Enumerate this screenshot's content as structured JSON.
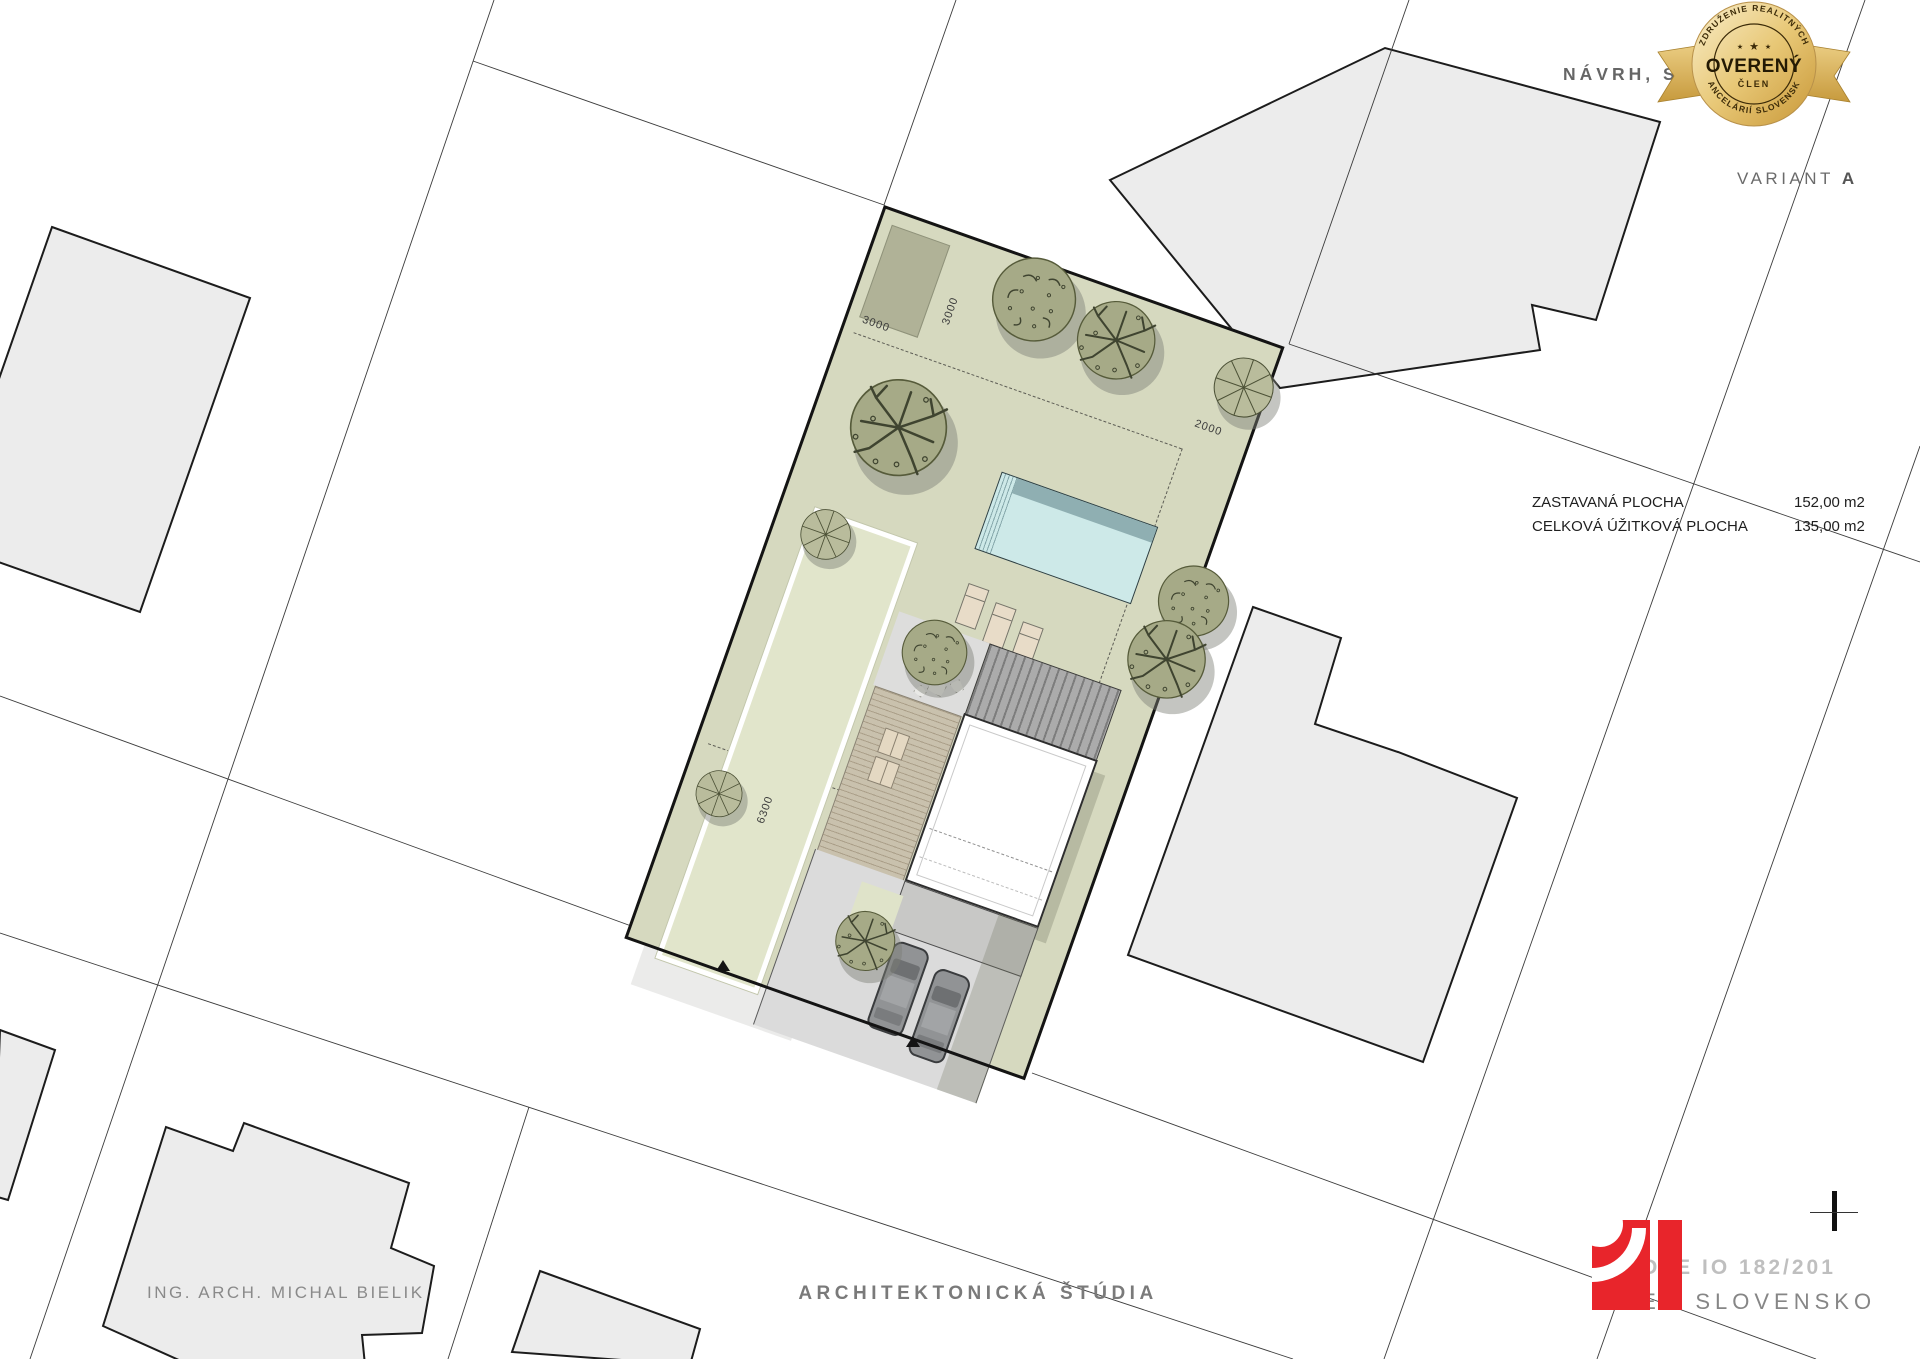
{
  "header": {
    "navrh": "NÁVRH, S",
    "variant": "VARIANT",
    "variant_letter": "A"
  },
  "badge": {
    "arc_top": "ZDRUŽENIE REALITNÝCH",
    "center": "OVERENÝ",
    "sub": "ČLEN",
    "arc_bottom": "KANCELÁRIÍ SLOVENSKA",
    "stars_small_left": "★",
    "stars_big": "★",
    "stars_small_right": "★"
  },
  "areas": {
    "rows": [
      {
        "label": "ZASTAVANÁ PLOCHA",
        "value": "152,00 m2"
      },
      {
        "label": "CELKOVÁ ÚŽITKOVÁ PLOCHA",
        "value": "135,00 m2"
      }
    ]
  },
  "dimensions": {
    "shed_width": "3000",
    "shed_offset": "3000",
    "side_setback": "2000",
    "strip_length": "6300"
  },
  "footer": {
    "architect": "ING. ARCH. MICHAL BIELIK",
    "title": "ARCHITEKTONICKÁ ŠTÚDIA"
  },
  "stamp": {
    "line1": "OTE IO 182/201",
    "line2": "IE - SLOVENSKO"
  },
  "colors": {
    "parcel_green": "#d6d9bf",
    "pool_water": "#cde9e8",
    "logo_red": "#e8252b",
    "badge_gold": "#d4a43c"
  }
}
